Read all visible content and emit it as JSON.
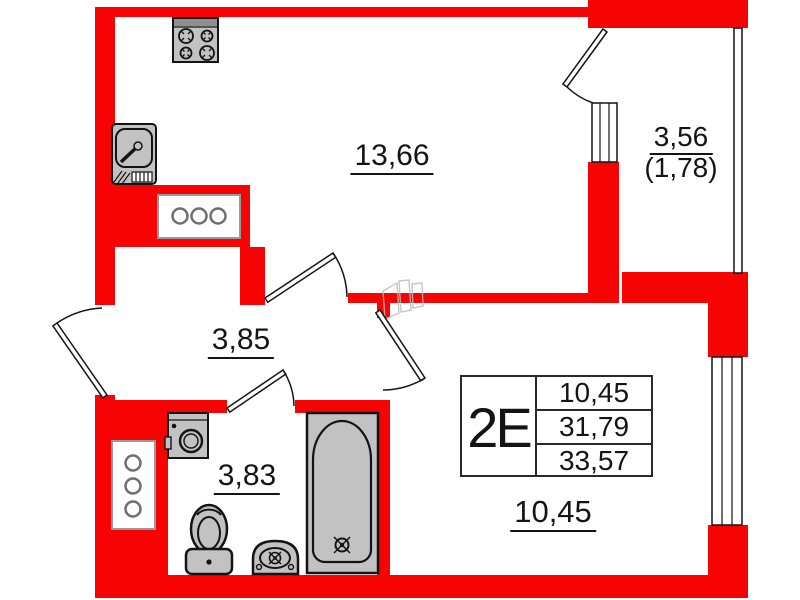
{
  "plan": {
    "unit_card": {
      "type": "2Е",
      "rows": [
        "10,45",
        "31,79",
        "33,57"
      ]
    },
    "rooms": {
      "kitchen_living": "13,66",
      "hallway": "3,85",
      "bathroom": "3,83",
      "bedroom": "10,45",
      "balcony": "3,56",
      "balcony_reduced": "(1,78)"
    },
    "colors": {
      "wall_red": "#f70303",
      "fixture_gray": "#c2c2c2",
      "outline_black": "#141414",
      "vent_gray": "#8c8c8c"
    },
    "icons": [
      "stove-icon",
      "kitchen-sink-icon",
      "vent-shaft-icon",
      "washing-machine-icon",
      "toilet-icon",
      "washbasin-icon",
      "bathtub-icon",
      "door-swing-icon",
      "window-icon"
    ]
  }
}
